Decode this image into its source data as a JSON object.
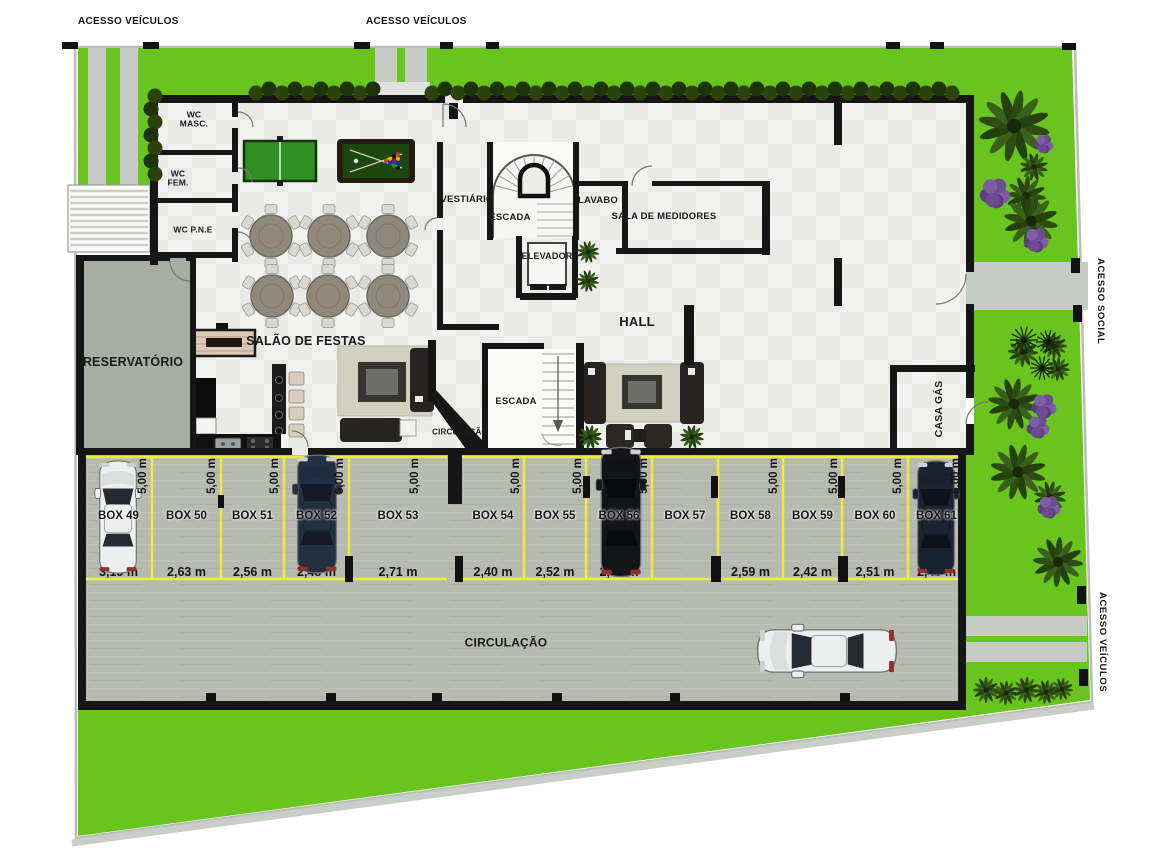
{
  "site": {
    "access_top_left": "ACESSO VEÍCULOS",
    "access_top_center": "ACESSO VEÍCULOS",
    "access_right_social": "ACESSO SOCIAL",
    "access_right_vehicles": "ACESSO VEÍCULOS"
  },
  "rooms": {
    "wc_masc": "WC\nMASC.",
    "wc_fem": "WC\nFEM.",
    "wc_pne": "WC P.N.E",
    "vestiario": "VESTIÁRIO",
    "escada_top": "ESCADA",
    "lavabo": "LAVABO",
    "elevador": "ELEVADOR",
    "sala_medidores": "SALA DE MEDIDORES",
    "hall": "HALL",
    "salao_festas": "SALÃO DE FESTAS",
    "reservatorio": "RESERVATÓRIO",
    "escada_hall": "ESCADA",
    "circulacao_small": "CIRCULAÇÃO",
    "circulacao_main": "CIRCULAÇÃO",
    "casa_gas": "CASA GÁS"
  },
  "parking": {
    "boxes": [
      {
        "id": "box-49",
        "label": "BOX 49",
        "width_label": "3,15 m",
        "depth_label": "5,00 m",
        "car": "white"
      },
      {
        "id": "box-50",
        "label": "BOX 50",
        "width_label": "2,63 m",
        "depth_label": "5,00 m",
        "car": null
      },
      {
        "id": "box-51",
        "label": "BOX 51",
        "width_label": "2,56 m",
        "depth_label": "5,00 m",
        "car": null
      },
      {
        "id": "box-52",
        "label": "BOX 52",
        "width_label": "2,48 m",
        "depth_label": "5,00 m",
        "car": "dark-blue"
      },
      {
        "id": "box-53",
        "label": "BOX 53",
        "width_label": "2,71 m",
        "depth_label": "5,00 m",
        "car": null
      },
      {
        "id": "box-54",
        "label": "BOX 54",
        "width_label": "2,40 m",
        "depth_label": "5,00 m",
        "car": null
      },
      {
        "id": "box-55",
        "label": "BOX 55",
        "width_label": "2,52 m",
        "depth_label": "5,00 m",
        "car": null
      },
      {
        "id": "box-56",
        "label": "BOX 56",
        "width_label": "2,62 m",
        "depth_label": "5,00 m",
        "car": "black"
      },
      {
        "id": "box-57",
        "label": "BOX 57",
        "width_label": null,
        "depth_label": null,
        "car": null
      },
      {
        "id": "box-58",
        "label": "BOX 58",
        "width_label": "2,59 m",
        "depth_label": "5,00 m",
        "car": null
      },
      {
        "id": "box-59",
        "label": "BOX 59",
        "width_label": "2,42 m",
        "depth_label": "5,00 m",
        "car": null
      },
      {
        "id": "box-60",
        "label": "BOX 60",
        "width_label": "2,51 m",
        "depth_label": "5,00 m",
        "car": null
      },
      {
        "id": "box-61",
        "label": "BOX 61",
        "width_label": "2,40 m",
        "depth_label": "5,00 m",
        "car": "dark-navy"
      }
    ],
    "circulation_car": "white"
  },
  "colors": {
    "lawn": "#69c41d",
    "paving": "#b6bab1",
    "marking_yellow": "#f0ed38",
    "wall": "#161616",
    "reservoir_gray": "#a7aca4"
  }
}
